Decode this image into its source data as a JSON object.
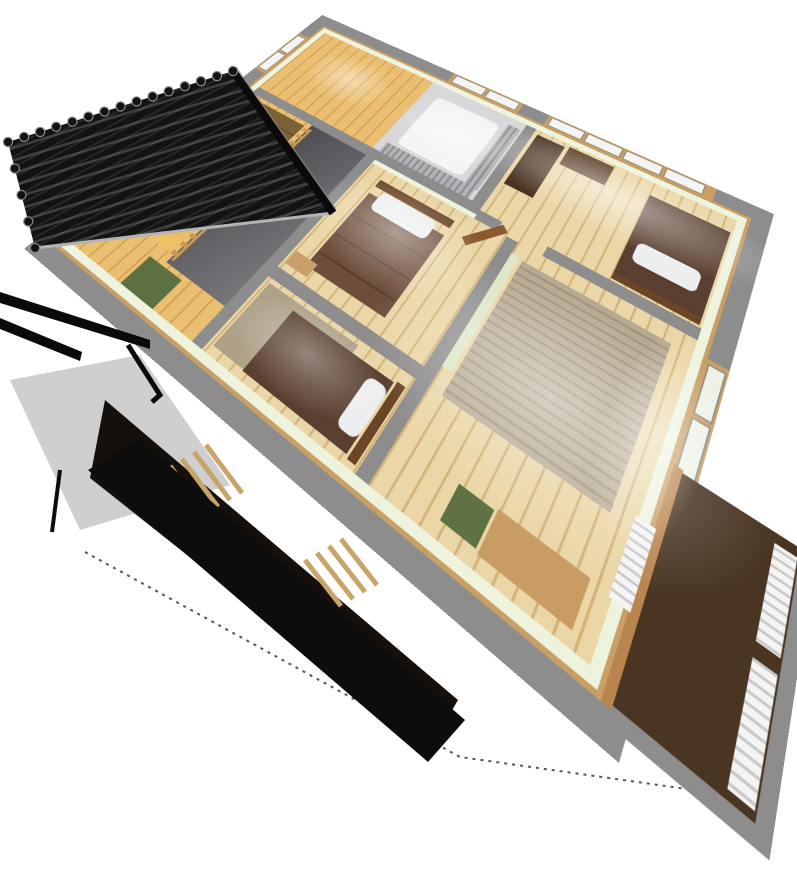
{
  "image": {
    "kind": "3d-cutaway-floorplan-render",
    "view": "bird's-eye isometric, plan rotated ~34deg",
    "background": "#ffffff"
  },
  "rooms": {
    "north_west": "stair-hall",
    "north_center": "closet-room",
    "north_east": "bedroom-north",
    "center": "bedroom-center",
    "south_center": "bedroom-south",
    "east": "bedroom-east",
    "south_east": "balcony",
    "west_opening": "stairwell-void"
  },
  "palette": {
    "bg": "#ffffff",
    "wall_top": "#8d8d8d",
    "wall_trim_wood": "#c99f63",
    "wall_face": "#eef3de",
    "floor_wood": "#ead6a6",
    "floor_plank_line": "#d3b277",
    "floor_warm": "#eabf72",
    "floor_warm_line": "#d49f50",
    "wic_floor": "#d8d8db",
    "rug_plain": "#aea188",
    "rug_striped": "#b7aa92",
    "rug_stripe_line": "#a2947c",
    "void_dark": "#4e4e52",
    "void_mid": "#77777b",
    "stair_mid": "#c79e58",
    "stair_bright": "#f2c368",
    "rail_wood": "#c89858",
    "shadow": "#000000",
    "duvet_dark": "#5a3f30",
    "duvet_mid": "#6d4e3a",
    "pillow": "#eceef0",
    "headboard": "#6a4626",
    "door_wood": "#8a5a2e",
    "desk_dark": "#4a3322",
    "cabinet": "#5a3a24",
    "desk_tan": "#c89c62",
    "chair_green": "#5f7243",
    "cushion_green": "#5c7040",
    "fusuma": "#dde6c6",
    "futon": "#f4f4f6",
    "curtain_gray": "#b4b4b8",
    "curtain_gray_dark": "#8e8e93",
    "window_pane": "#f4f4f2",
    "window_pane_green": "#eef2e6",
    "window_mullion": "#8a8a8a",
    "blind_white": "#f4f4f4",
    "blind_line": "#c9c9c9",
    "balcony_floor": "#4a3523",
    "balcony_sill": "#b9854e",
    "table_wood": "#caa06a",
    "glow": "#ffffff",
    "roof_black": "#131313",
    "roof_row": "#3e3e3e",
    "roof_glint": "#8a8a8a",
    "eave_black": "#0a0a0a",
    "fascia": "#b4b4b4",
    "plane_gray": "#cfcfcf",
    "under_dark": "#15100c",
    "slat_wood": "#c9a468",
    "lower_black": "#0d0d0d",
    "dotted": "#555555"
  }
}
